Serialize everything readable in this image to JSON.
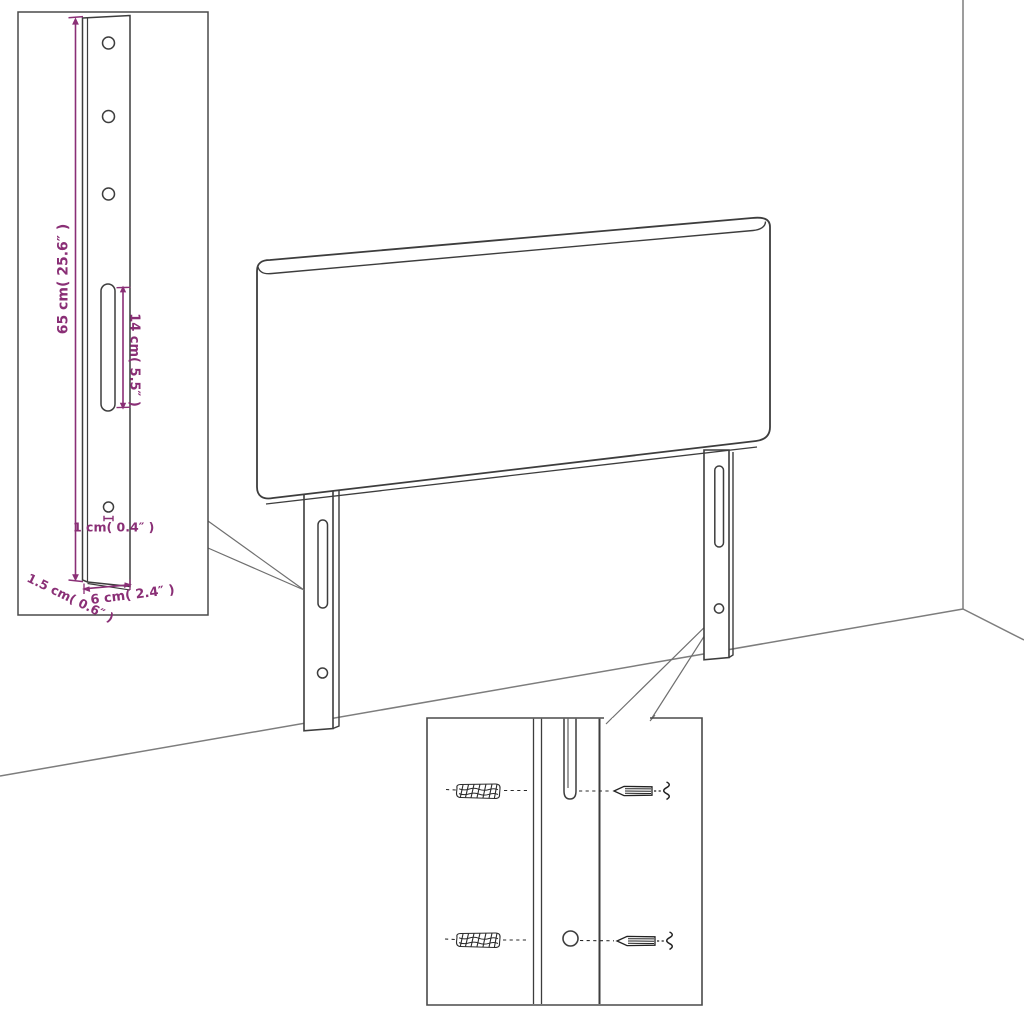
{
  "diagram": {
    "background": "#ffffff",
    "line_color": "#3d3d3d",
    "room_line_color": "#7d7d7d",
    "dimension_color": "#8a2f76",
    "leg_detail_inset": {
      "labels": {
        "height": "65 cm( 25.6″ )",
        "slot_length": "14 cm( 5.5″ )",
        "hole_size": "1 cm( 0.4″ )",
        "thickness": "1.5 cm( 0.6″ )",
        "width": "6 cm( 2.4″ )"
      },
      "hole_count": 3,
      "slot_count": 1
    },
    "mounting_detail_inset": {
      "anchor_count": 2,
      "screw_count": 2,
      "hole_count": 1,
      "slot_count": 1
    },
    "scene": {
      "panel": "headboard",
      "leg_count": 2
    }
  }
}
